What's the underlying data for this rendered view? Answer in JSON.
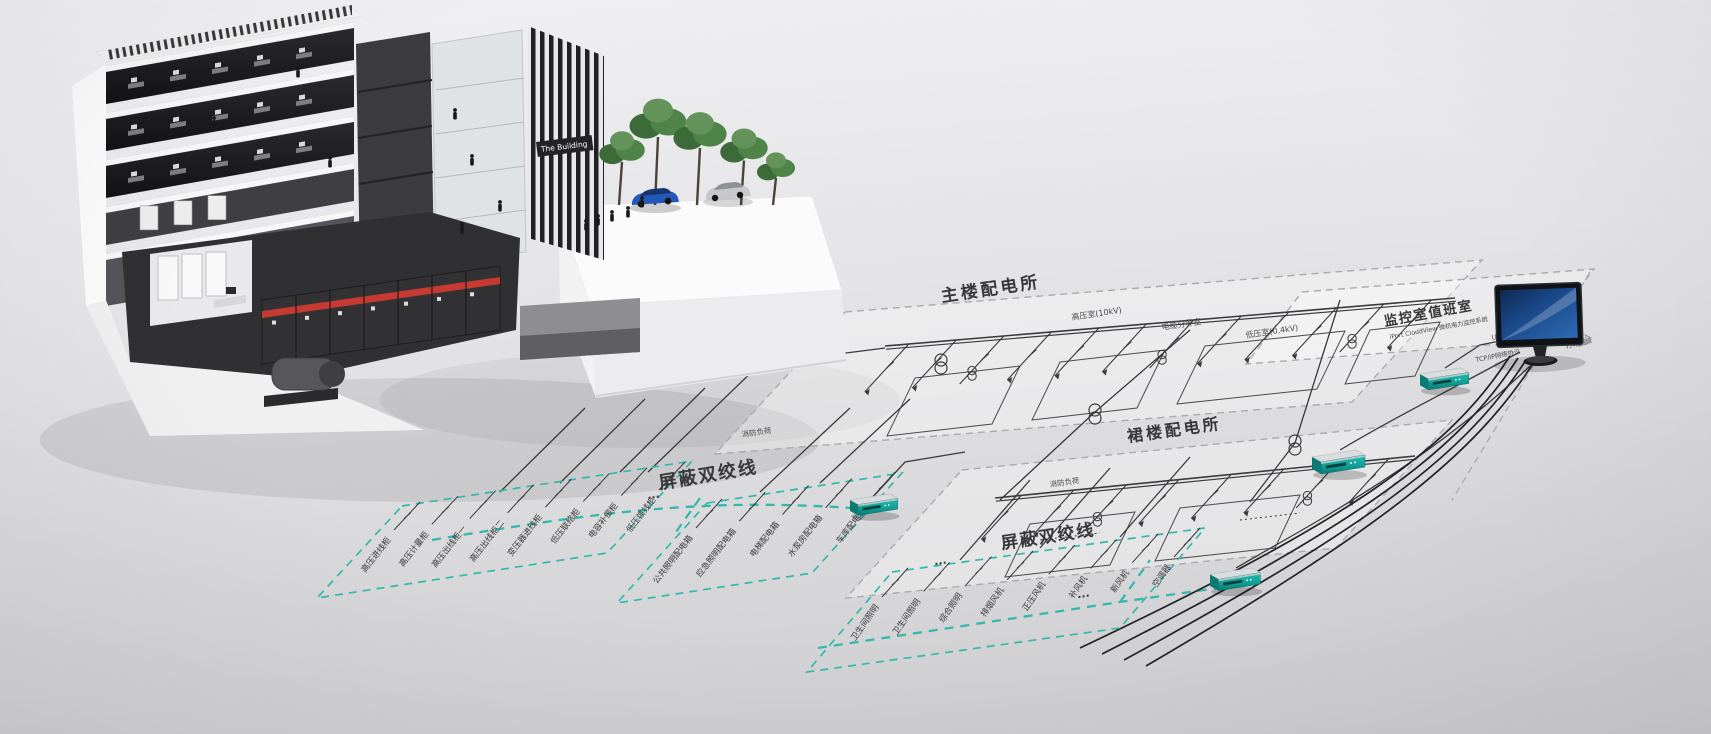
{
  "scene": {
    "background_top": "#f1f1f3",
    "background_bottom": "#cdcdcf",
    "line_color": "#3a3a3c",
    "dashed_border_color": "#ababad",
    "stp_color": "#35b8ac",
    "device_color": "#12a096",
    "accent_red": "#c63a32",
    "screen_blue": "#1b3f77"
  },
  "building": {
    "sign": "The Building"
  },
  "diagram": {
    "main_substation": {
      "label": "主楼配电所",
      "room_labels": [
        "高压室(10kV)",
        "电缆分界室",
        "低压室(0.4kV)"
      ],
      "fire_load": "消防负荷"
    },
    "podium_substation": {
      "label": "裙楼配电所",
      "fire_load": "消防负荷"
    },
    "monitor_room": {
      "label": "监控室值班室",
      "subtitle": "iPort CloudView 微机电力监控系统",
      "ups": "UPS",
      "printer": "打印机",
      "protocol": "TCP/IP网络协议"
    },
    "stp_bus_1": "屏蔽双绞线",
    "stp_bus_2": "屏蔽双绞线",
    "ellipsis": "···",
    "feeder_groups": [
      {
        "labels": [
          "高压进线柜",
          "高压计量柜",
          "高压出线柜一",
          "高压出线柜二",
          "变压器进线柜",
          "低压联络柜",
          "电容补偿柜",
          "低压馈线柜"
        ]
      },
      {
        "labels": [
          "公共照明配电箱",
          "应急照明配电箱",
          "电梯配电箱",
          "水泵房配电箱",
          "车库配电箱"
        ]
      },
      {
        "labels": [
          "卫生间照明",
          "卫生间照明",
          "综合照明",
          "排烟风机",
          "正压风机",
          "补风机",
          "新风机",
          "空调器"
        ]
      }
    ]
  }
}
